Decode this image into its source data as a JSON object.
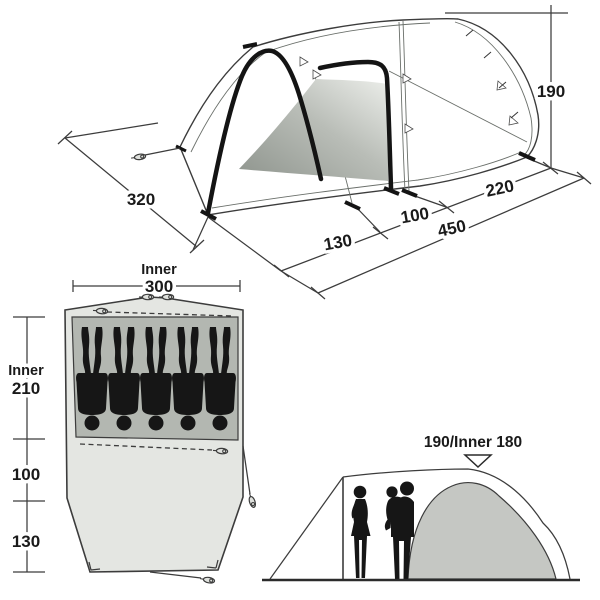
{
  "diagram_title": "tent-dimensions-diagram",
  "colors": {
    "line": "#3c3c3c",
    "dark": "#141414",
    "inner_floor": "#b3b7b1",
    "groundsheet": "#e4e6e2",
    "dome_door": "#c5c7c3",
    "door_gradient_dark": "#90968f",
    "door_gradient_light": "#e9ebe7",
    "silhouette": "#161616"
  },
  "perspective_view": {
    "dim_width": "320",
    "dim_front_depth": "130",
    "dim_mid_depth": "100",
    "dim_total_length": "450",
    "dim_living_depth": "220",
    "dim_height": "190"
  },
  "floor_plan": {
    "inner_width_title": "Inner",
    "inner_width": "300",
    "inner_depth_title": "Inner",
    "inner_depth": "210",
    "mid_depth": "100",
    "front_depth": "130",
    "sleeper_count": 5
  },
  "elevation_view": {
    "height_label": "190/Inner 180"
  }
}
